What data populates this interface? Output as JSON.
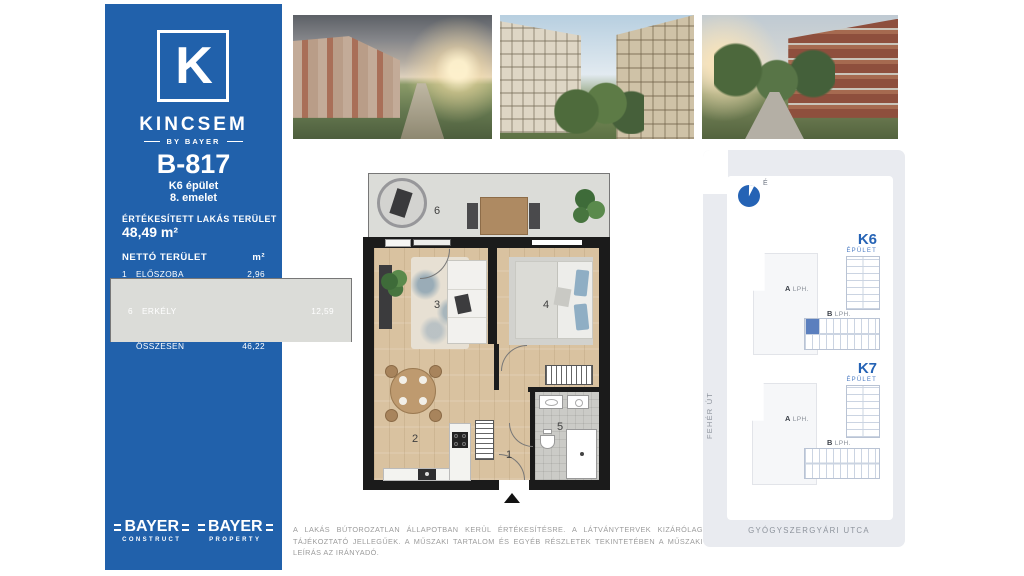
{
  "sidebar": {
    "logo_letter": "K",
    "brand_name": "KINCSEM",
    "brand_byline": "BY BAYER",
    "unit_id": "B-817",
    "building_line": "K6 épület",
    "floor_line": "8. emelet",
    "sold_area_label": "ÉRTÉKESÍTETT LAKÁS TERÜLET",
    "sold_area_value": "48,49 m²",
    "table_header": "NETTÓ TERÜLET",
    "table_unit": "m²",
    "rooms": [
      {
        "num": "1",
        "name": "ELŐSZOBA",
        "area": "2,96"
      },
      {
        "num": "2",
        "name": "KONYHA-ÉTKEZŐ",
        "area": "8,97"
      },
      {
        "num": "3",
        "name": "NAPPALI",
        "area": "17,28"
      },
      {
        "num": "4",
        "name": "SZOBA",
        "area": "12,97"
      },
      {
        "num": "5",
        "name": "FÜRDŐSZOBA",
        "area": "4,04"
      }
    ],
    "total_row": {
      "name": "ÖSSZESEN",
      "area": "46,22"
    },
    "balcony_row": {
      "num": "6",
      "name": "ERKÉLY",
      "area": "12,59"
    },
    "footer_logos": [
      {
        "name": "BAYER",
        "sub": "CONSTRUCT"
      },
      {
        "name": "BAYER",
        "sub": "PROPERTY"
      }
    ]
  },
  "photos": [
    {
      "name": "exterior-park-view"
    },
    {
      "name": "courtyard-view"
    },
    {
      "name": "street-promenade-view"
    }
  ],
  "floorplan": {
    "labels": {
      "hall": "1",
      "kitchen": "2",
      "living": "3",
      "bedroom": "4",
      "bath": "5",
      "balcony": "6"
    }
  },
  "sitemap": {
    "compass_label": "É",
    "buildings": [
      {
        "id": "K6",
        "sub": "ÉPÜLET",
        "stairs": [
          {
            "letter": "A",
            "label": "LPH."
          },
          {
            "letter": "B",
            "label": "LPH."
          }
        ],
        "highlighted": true
      },
      {
        "id": "K7",
        "sub": "ÉPÜLET",
        "stairs": [
          {
            "letter": "A",
            "label": "LPH."
          },
          {
            "letter": "B",
            "label": "LPH."
          }
        ],
        "highlighted": false
      }
    ],
    "street_left": "FEHÉR ÚT",
    "street_bottom": "GYÓGYSZERGYÁRI UTCA"
  },
  "disclaimer": "A LAKÁS BÚTOROZATLAN ÁLLAPOTBAN KERÜL ÉRTÉKESÍTÉSRE. A LÁTVÁNYTERVEK KIZÁRÓLAG TÁJÉKOZTATÓ JELLEGŰEK. A MŰSZAKI TARTALOM ÉS EGYÉB RÉSZLETEK TEKINTETÉBEN A MŰSZAKI LEÍRÁS AZ IRÁNYADÓ.",
  "colors": {
    "brand_blue": "#2161AB",
    "accent_blue": "#2563B5",
    "unit_highlight": "#5B7FBE"
  }
}
